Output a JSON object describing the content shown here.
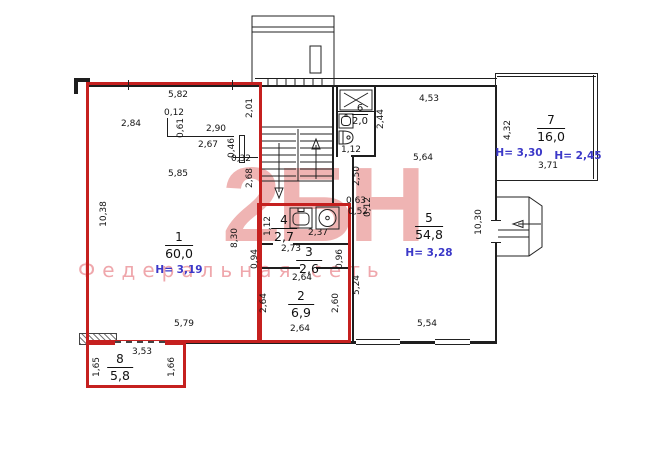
{
  "plan": {
    "watermark": {
      "big_text": "2БН",
      "tagline": "Федеральная сеть"
    },
    "rooms": [
      {
        "number": "1",
        "area": "60,0",
        "height": "H= 3,19"
      },
      {
        "number": "2",
        "area": "6,9"
      },
      {
        "number": "3",
        "area": "2,6"
      },
      {
        "number": "4",
        "area": "2,7"
      },
      {
        "number": "5",
        "area": "54,8",
        "height": "H= 3,28"
      },
      {
        "number": "6",
        "area": "2,0"
      },
      {
        "number": "7",
        "area": "16,0",
        "height": "H= 3,30",
        "height2": "H= 2,45"
      },
      {
        "number": "8",
        "area": "5,8"
      }
    ],
    "dims": [
      "5,82",
      "2,84",
      "0,12",
      "2,90",
      "2,67",
      "0,32",
      "5,85",
      "5,79",
      "3,53",
      "4,53",
      "5,64",
      "5,54",
      "3,71",
      "1,12",
      "0,63",
      "0,52",
      "2,37",
      "2,73",
      "2,64",
      "2,64",
      "2,01",
      "0,46",
      "2,68",
      "10,38",
      "8,30",
      "1,65",
      "1,66",
      "0,61",
      "1,12",
      "0,94",
      "0,96",
      "2,64",
      "2,60",
      "5,24",
      "2,50",
      "0,12",
      "2,44",
      "10,30",
      "4,32"
    ],
    "icons": [
      "sink-icon",
      "washbasin-icon",
      "toilet-icon",
      "boiler-icon",
      "stairs-arrow-up-icon",
      "stairs-arrow-down-icon",
      "entrance-arrow-icon"
    ],
    "colors": {
      "contour": "#c5201f",
      "walls": "#1e1e1e",
      "height_text": "#3b38c8",
      "watermark": "#e0706e",
      "watermark_tagline": "#eca1a6"
    }
  }
}
